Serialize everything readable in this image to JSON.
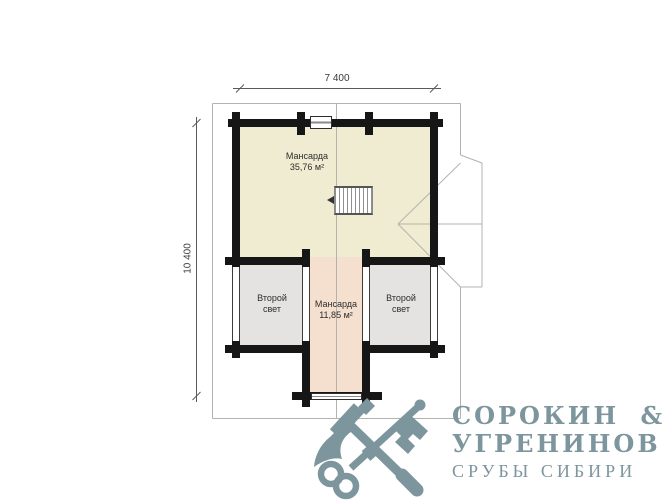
{
  "plan": {
    "dim_width": "7 400",
    "dim_height": "10 400",
    "rooms": {
      "attic_main": {
        "name": "Мансарда",
        "area": "35,76 м²"
      },
      "attic_small": {
        "name": "Мансарда",
        "area": "11,85 м²"
      },
      "void_left": {
        "name": "Второй свет"
      },
      "void_right": {
        "name": "Второй свет"
      }
    },
    "icons": [
      "stairs-icon",
      "window-icon",
      "dormer-outline"
    ]
  },
  "logo": {
    "line1": "СОРОКИН &",
    "line2": "УГРЕНИНОВ",
    "line3": "СРУБЫ СИБИРИ",
    "icons": [
      "axe-icon",
      "key-icon"
    ]
  },
  "colors": {
    "wall": "#161616",
    "attic_fill": "#f0ecd1",
    "small_attic_fill": "#f5dfcf",
    "void_fill": "#e4e3e1",
    "outline": "#b3b3ad",
    "dim": "#5a5a5a",
    "logo": "#7d959d"
  }
}
